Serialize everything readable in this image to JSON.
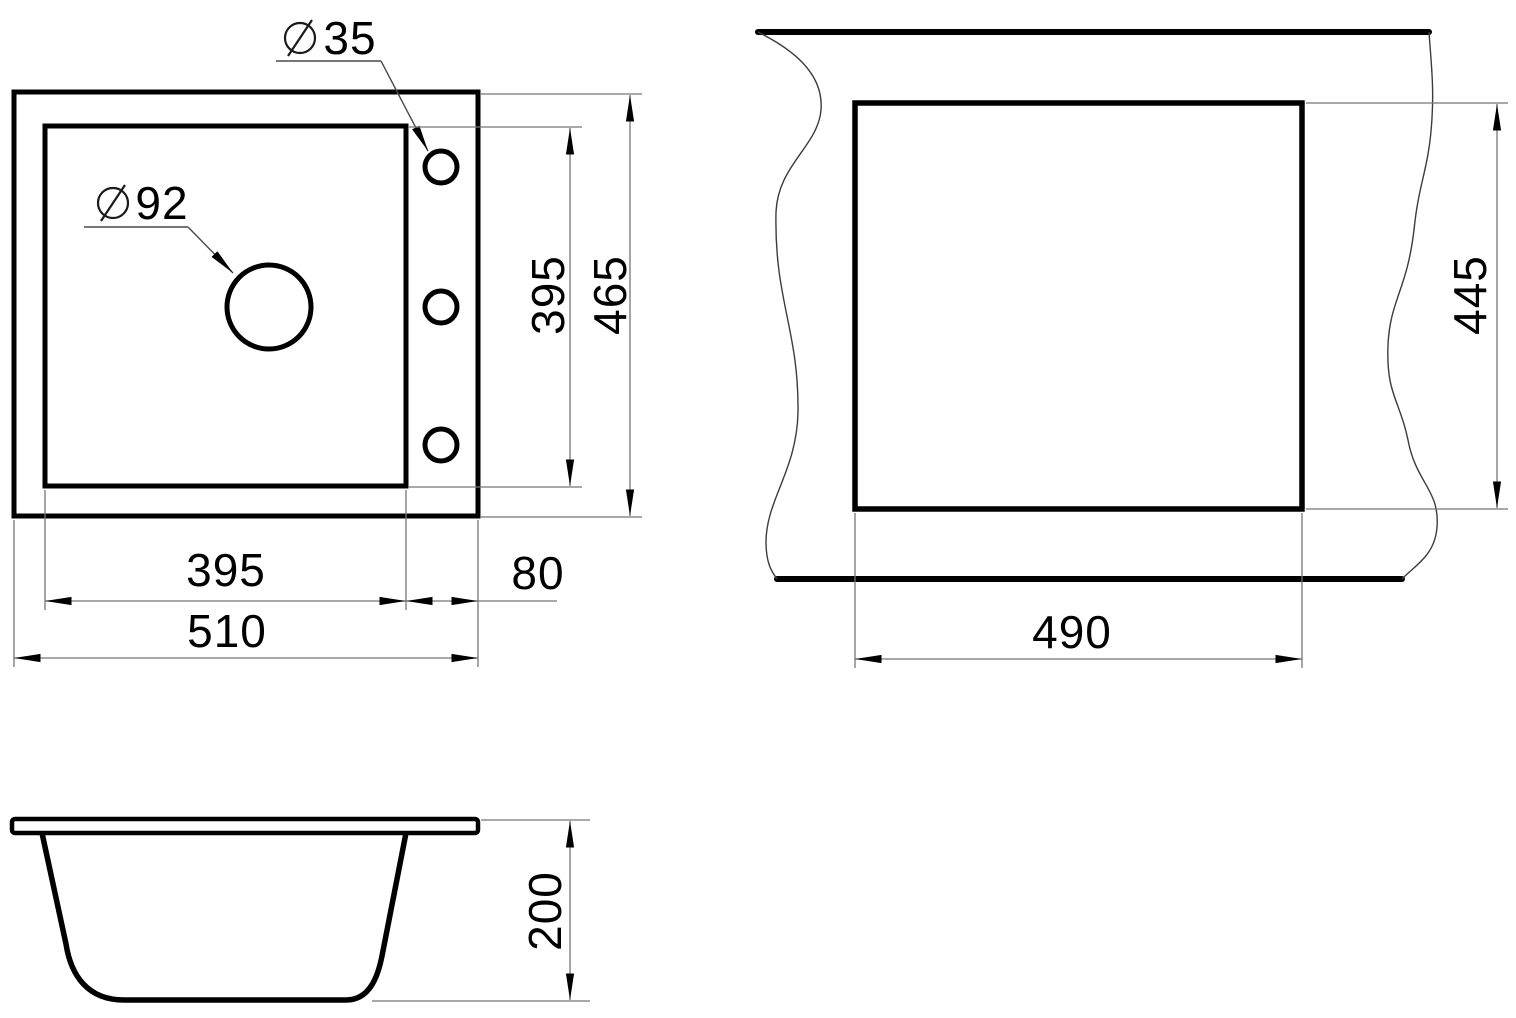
{
  "drawing": {
    "title": "sink-dimension-drawing",
    "colors": {
      "outline": "#000000",
      "dimension_line": "#767676",
      "leader_line": "#4a4a4a",
      "text": "#000000",
      "background": "#ffffff"
    },
    "top_view": {
      "tap_hole_label": {
        "symbol": "⌀",
        "value": "35"
      },
      "drain_hole_label": {
        "symbol": "⌀",
        "value": "92"
      },
      "bowl_width": "395",
      "ledge_width": "80",
      "overall_width": "510",
      "bowl_depth": "395",
      "overall_depth": "465"
    },
    "cutout_view": {
      "cutout_width": "490",
      "cutout_depth": "445"
    },
    "side_view": {
      "depth": "200"
    }
  }
}
